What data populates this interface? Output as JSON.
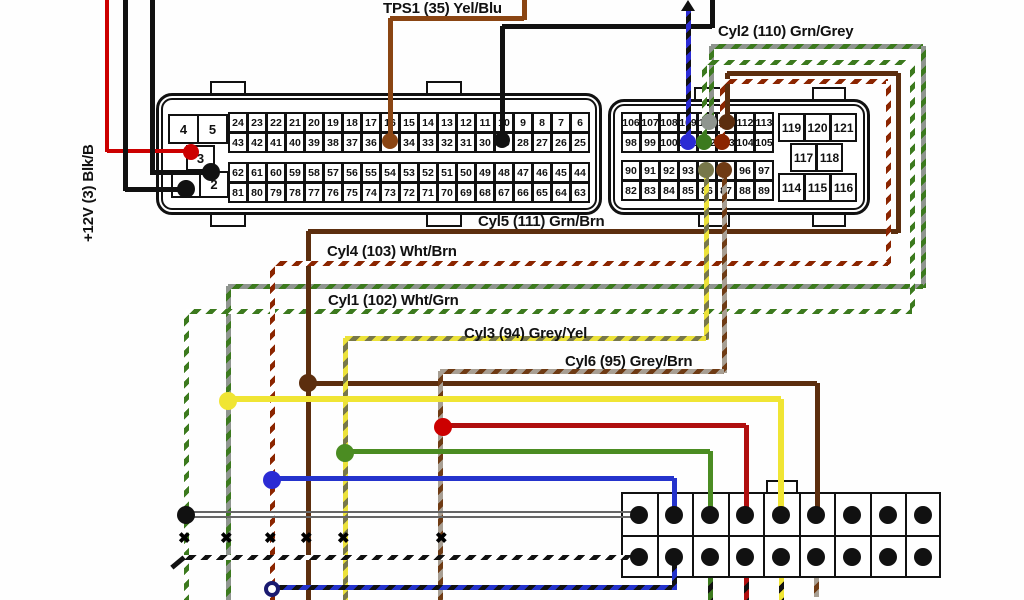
{
  "labels": {
    "plus12v": {
      "text": "+12V (3) Blk/B",
      "x": 80,
      "y": 242,
      "rotated": true
    },
    "tps1": {
      "text": "TPS1 (35) Yel/Blu",
      "x": 383,
      "y": 0
    },
    "cyl2": {
      "text": "Cyl2 (110) Grn/Grey",
      "x": 718,
      "y": 23
    },
    "cyl5": {
      "text": "Cyl5 (111) Grn/Brn",
      "x": 478,
      "y": 213
    },
    "cyl4": {
      "text": "Cyl4 (103) Wht/Brn",
      "x": 327,
      "y": 243
    },
    "cyl1": {
      "text": "Cyl1 (102) Wht/Grn",
      "x": 328,
      "y": 292
    },
    "cyl3": {
      "text": "Cyl3 (94) Grey/Yel",
      "x": 464,
      "y": 325
    },
    "cyl6": {
      "text": "Cyl6 (95) Grey/Brn",
      "x": 565,
      "y": 353
    }
  },
  "colors": {
    "black": "#111111",
    "red12v": "#cc0000",
    "tps_brown": "#8a4513",
    "cyl5_brown": "#5c2e0e",
    "cyl4_red": "#8b2500",
    "cyl1_green": "#3c7a1e",
    "cyl2_grey": "#8f958f",
    "cyl3_yellow": "#ece23a",
    "cyl3_dash": "#77774a",
    "cyl6_grey": "#a89f93",
    "cyl6_brown": "#6f3b14",
    "blue_wire": "#2b2bd4",
    "branch_yellow": "#f0e534",
    "branch_blue": "#2433cc",
    "branch_green": "#4b8c22",
    "branch_red": "#b00f0f",
    "pair_grey": "#666666",
    "white": "#ffffff"
  },
  "diagram": {
    "left_connector": {
      "name": "ecu-connector-left",
      "shell": {
        "x": 156,
        "y": 93,
        "w": 446,
        "h": 122
      },
      "tabs": [
        {
          "x": 210,
          "y": 81,
          "w": 36,
          "h": 14
        },
        {
          "x": 426,
          "y": 81,
          "w": 36,
          "h": 14
        },
        {
          "x": 210,
          "y": 213,
          "w": 36,
          "h": 14
        },
        {
          "x": 426,
          "y": 213,
          "w": 36,
          "h": 14
        }
      ],
      "small_pins": [
        {
          "label": "4",
          "x": 168,
          "y": 114,
          "w": 30,
          "h": 29
        },
        {
          "label": "5",
          "x": 197,
          "y": 114,
          "w": 30,
          "h": 29
        },
        {
          "label": "3",
          "x": 186,
          "y": 145,
          "w": 28,
          "h": 25
        },
        {
          "label": "1",
          "x": 171,
          "y": 171,
          "w": 29,
          "h": 26
        },
        {
          "label": "2",
          "x": 199,
          "y": 171,
          "w": 29,
          "h": 26
        }
      ],
      "blocks": [
        {
          "x": 228,
          "y": 112,
          "cw": 19,
          "ch": 20,
          "rows": [
            [
              24,
              23,
              22,
              21,
              20,
              19,
              18,
              17,
              16,
              15,
              14,
              13,
              12,
              11,
              10,
              9,
              8,
              7,
              6
            ],
            [
              43,
              42,
              41,
              40,
              39,
              38,
              37,
              36,
              35,
              34,
              33,
              32,
              31,
              30,
              29,
              28,
              27,
              26,
              25
            ]
          ]
        },
        {
          "x": 228,
          "y": 162,
          "cw": 19,
          "ch": 20,
          "rows": [
            [
              62,
              61,
              60,
              59,
              58,
              57,
              56,
              55,
              54,
              53,
              52,
              51,
              50,
              49,
              48,
              47,
              46,
              45,
              44
            ],
            [
              81,
              80,
              79,
              78,
              77,
              76,
              75,
              74,
              73,
              72,
              71,
              70,
              69,
              68,
              67,
              66,
              65,
              64,
              63
            ]
          ]
        }
      ]
    },
    "right_connector": {
      "name": "ecu-connector-right",
      "shell": {
        "x": 608,
        "y": 99,
        "w": 262,
        "h": 116
      },
      "tabs": [
        {
          "x": 694,
          "y": 87,
          "w": 36,
          "h": 14
        },
        {
          "x": 812,
          "y": 87,
          "w": 34,
          "h": 14
        },
        {
          "x": 698,
          "y": 213,
          "w": 32,
          "h": 14
        },
        {
          "x": 812,
          "y": 213,
          "w": 34,
          "h": 14
        }
      ],
      "blocks": [
        {
          "x": 621,
          "y": 112,
          "cw": 19,
          "ch": 20,
          "rows": [
            [
              106,
              107,
              108,
              109,
              110,
              111,
              112,
              113
            ],
            [
              98,
              99,
              100,
              101,
              102,
              103,
              104,
              105
            ]
          ]
        },
        {
          "x": 621,
          "y": 160,
          "cw": 19,
          "ch": 20,
          "rows": [
            [
              90,
              91,
              92,
              93,
              94,
              95,
              96,
              97
            ],
            [
              82,
              83,
              84,
              85,
              86,
              87,
              88,
              89
            ]
          ]
        }
      ],
      "side_cells": [
        {
          "label": "119",
          "x": 778,
          "y": 113,
          "w": 26,
          "h": 28
        },
        {
          "label": "120",
          "x": 804,
          "y": 113,
          "w": 26,
          "h": 28
        },
        {
          "label": "121",
          "x": 830,
          "y": 113,
          "w": 26,
          "h": 28
        },
        {
          "label": "117",
          "x": 790,
          "y": 143,
          "w": 26,
          "h": 28
        },
        {
          "label": "118",
          "x": 816,
          "y": 143,
          "w": 26,
          "h": 28
        },
        {
          "label": "114",
          "x": 778,
          "y": 173,
          "w": 26,
          "h": 28
        },
        {
          "label": "115",
          "x": 804,
          "y": 173,
          "w": 26,
          "h": 28
        },
        {
          "label": "116",
          "x": 830,
          "y": 173,
          "w": 26,
          "h": 28
        }
      ]
    },
    "bottom_connector": {
      "name": "coil-connector-strip",
      "x": 621,
      "y": 492,
      "w": 320,
      "h": 86,
      "cols": 9,
      "mid_y": 535,
      "tab": {
        "x": 766,
        "y": 480,
        "w": 32,
        "h": 14
      },
      "dot_cols": [
        639,
        674,
        710,
        745,
        781,
        816,
        852,
        888,
        923
      ],
      "dot_rows": [
        515,
        557
      ]
    },
    "wires": [
      {
        "name": "wire-12v",
        "w": 4,
        "base": "red12v",
        "segs": [
          [
            "v",
            107,
            0,
            152
          ],
          [
            "h",
            107,
            193,
            151
          ]
        ]
      },
      {
        "name": "wire-gnd-pin1",
        "w": 5,
        "base": "black",
        "segs": [
          [
            "v",
            125,
            0,
            191
          ],
          [
            "h",
            125,
            188,
            189
          ]
        ]
      },
      {
        "name": "wire-gnd-pin2",
        "w": 5,
        "base": "black",
        "segs": [
          [
            "v",
            152,
            0,
            175
          ],
          [
            "h",
            152,
            213,
            172
          ]
        ]
      },
      {
        "name": "wire-tps1",
        "w": 5,
        "base": "tps_brown",
        "segs": [
          [
            "v",
            524,
            0,
            20
          ],
          [
            "h",
            390,
            524,
            18
          ],
          [
            "v",
            390,
            18,
            144
          ]
        ]
      },
      {
        "name": "wire-black-pin29",
        "w": 5,
        "base": "black",
        "segs": [
          [
            "v",
            712,
            0,
            28
          ],
          [
            "h",
            502,
            712,
            26
          ],
          [
            "v",
            502,
            26,
            142
          ]
        ]
      },
      {
        "name": "wire-blue-pin101",
        "w": 5,
        "base": "blue_wire",
        "dash": "black",
        "segs": [
          [
            "v",
            688,
            9,
            144
          ]
        ]
      },
      {
        "name": "wire-cyl2",
        "w": 5,
        "base": "cyl2_grey",
        "dash": "cyl1_green",
        "segs": [
          [
            "v",
            711,
            46,
            122
          ],
          [
            "h",
            711,
            923,
            46
          ],
          [
            "v",
            923,
            46,
            288
          ],
          [
            "h",
            228,
            923,
            286
          ],
          [
            "v",
            228,
            286,
            600
          ]
        ]
      },
      {
        "name": "wire-cyl1",
        "w": 5,
        "base": "white",
        "dash": "cyl1_green",
        "segs": [
          [
            "v",
            704,
            62,
            142
          ],
          [
            "h",
            704,
            912,
            62
          ],
          [
            "v",
            912,
            62,
            313
          ],
          [
            "h",
            186,
            912,
            311
          ],
          [
            "v",
            186,
            311,
            600
          ]
        ]
      },
      {
        "name": "wire-cyl5",
        "w": 5,
        "base": "cyl5_brown",
        "segs": [
          [
            "v",
            727,
            73,
            122
          ],
          [
            "h",
            727,
            898,
            73
          ],
          [
            "v",
            898,
            73,
            233
          ],
          [
            "h",
            308,
            898,
            231
          ],
          [
            "v",
            308,
            231,
            600
          ],
          [
            "h",
            308,
            817,
            383
          ],
          [
            "v",
            817,
            383,
            517
          ]
        ]
      },
      {
        "name": "wire-cyl4",
        "w": 5,
        "base": "white",
        "dash": "cyl4_red",
        "segs": [
          [
            "v",
            722,
            81,
            142
          ],
          [
            "h",
            722,
            888,
            81
          ],
          [
            "v",
            888,
            81,
            265
          ],
          [
            "h",
            272,
            888,
            263
          ],
          [
            "v",
            272,
            263,
            600
          ]
        ]
      },
      {
        "name": "wire-cyl3",
        "w": 5,
        "base": "cyl3_yellow",
        "dash": "cyl3_dash",
        "segs": [
          [
            "v",
            706,
            172,
            340
          ],
          [
            "h",
            345,
            706,
            338
          ],
          [
            "v",
            345,
            338,
            600
          ]
        ]
      },
      {
        "name": "wire-cyl6",
        "w": 5,
        "base": "cyl6_grey",
        "dash": "cyl6_brown",
        "segs": [
          [
            "v",
            724,
            172,
            373
          ],
          [
            "h",
            440,
            724,
            371
          ],
          [
            "v",
            440,
            371,
            600
          ]
        ]
      },
      {
        "name": "branch-yellow-coil5",
        "w": 6,
        "base": "branch_yellow",
        "segs": [
          [
            "h",
            228,
            781,
            399
          ],
          [
            "v",
            781,
            399,
            517
          ]
        ]
      },
      {
        "name": "branch-red-coil4",
        "w": 5,
        "base": "branch_red",
        "segs": [
          [
            "h",
            443,
            746,
            425
          ],
          [
            "v",
            746,
            425,
            517
          ]
        ]
      },
      {
        "name": "branch-green-coil3",
        "w": 5,
        "base": "branch_green",
        "segs": [
          [
            "h",
            345,
            710,
            451
          ],
          [
            "v",
            710,
            451,
            517
          ]
        ]
      },
      {
        "name": "branch-blue-coil2",
        "w": 5,
        "base": "branch_blue",
        "segs": [
          [
            "h",
            272,
            674,
            478
          ],
          [
            "v",
            674,
            478,
            517
          ]
        ]
      },
      {
        "name": "pair-grey-coil1-a",
        "w": 2,
        "base": "pair_grey",
        "segs": [
          [
            "h",
            186,
            640,
            512
          ]
        ]
      },
      {
        "name": "pair-grey-coil1-b",
        "w": 2,
        "base": "pair_grey",
        "segs": [
          [
            "h",
            186,
            640,
            517
          ]
        ]
      },
      {
        "name": "dash-black-coil1",
        "w": 5,
        "base": "white",
        "dash": "black",
        "segs": [
          [
            "h",
            181,
            640,
            557
          ]
        ]
      },
      {
        "name": "dash-blueblack-coil2",
        "w": 5,
        "base": "branch_blue",
        "dash": "black",
        "segs": [
          [
            "h",
            272,
            674,
            587
          ],
          [
            "v",
            674,
            557,
            590
          ]
        ]
      },
      {
        "name": "stub-coil3",
        "w": 5,
        "base": "cyl1_green",
        "dash": "black",
        "segs": [
          [
            "v",
            710,
            578,
            600
          ]
        ]
      },
      {
        "name": "stub-coil4",
        "w": 5,
        "base": "branch_red",
        "dash": "black",
        "segs": [
          [
            "v",
            746,
            578,
            600
          ]
        ]
      },
      {
        "name": "stub-coil5",
        "w": 5,
        "base": "branch_yellow",
        "dash": "black",
        "segs": [
          [
            "v",
            781,
            578,
            600
          ]
        ]
      },
      {
        "name": "stub-coil6",
        "w": 5,
        "base": "cyl6_grey",
        "dash": "cyl6_brown",
        "segs": [
          [
            "v",
            816,
            578,
            597
          ]
        ]
      }
    ],
    "dots": [
      {
        "name": "pin3-dot",
        "x": 191,
        "y": 152,
        "r": 8,
        "fill": "red12v"
      },
      {
        "name": "pin1-dot",
        "x": 186,
        "y": 189,
        "r": 9,
        "fill": "black"
      },
      {
        "name": "pin2-dot",
        "x": 211,
        "y": 172,
        "r": 9,
        "fill": "black"
      },
      {
        "name": "pin35-dot",
        "x": 390,
        "y": 141,
        "r": 8,
        "fill": "tps_brown"
      },
      {
        "name": "pin29-dot",
        "x": 502,
        "y": 140,
        "r": 8,
        "fill": "black"
      },
      {
        "name": "pin101-dot",
        "x": 688,
        "y": 142,
        "r": 8,
        "fill": "blue_wire"
      },
      {
        "name": "pin110-dot",
        "x": 709,
        "y": 122,
        "r": 8,
        "fill": "cyl2_grey"
      },
      {
        "name": "pin102-dot",
        "x": 704,
        "y": 142,
        "r": 8,
        "fill": "cyl1_green"
      },
      {
        "name": "pin111-dot",
        "x": 727,
        "y": 122,
        "r": 8,
        "fill": "cyl5_brown"
      },
      {
        "name": "pin103-dot",
        "x": 722,
        "y": 142,
        "r": 8,
        "fill": "cyl4_red"
      },
      {
        "name": "pin94-dot",
        "x": 706,
        "y": 170,
        "r": 8,
        "fill": "cyl3_dash"
      },
      {
        "name": "pin95-dot",
        "x": 724,
        "y": 170,
        "r": 8,
        "fill": "cyl6_brown"
      },
      {
        "name": "junction-cyl5-brown",
        "x": 308,
        "y": 383,
        "r": 9,
        "fill": "cyl5_brown"
      },
      {
        "name": "junction-cyl2-yellow",
        "x": 228,
        "y": 401,
        "r": 9,
        "fill": "branch_yellow"
      },
      {
        "name": "junction-cyl6-red",
        "x": 443,
        "y": 427,
        "r": 9,
        "fill": "red12v"
      },
      {
        "name": "junction-cyl3-green",
        "x": 345,
        "y": 453,
        "r": 9,
        "fill": "branch_green"
      },
      {
        "name": "junction-cyl4-blue",
        "x": 272,
        "y": 480,
        "r": 9,
        "fill": "blue_wire"
      },
      {
        "name": "junction-cyl1-black",
        "x": 186,
        "y": 515,
        "r": 9,
        "fill": "black"
      }
    ],
    "xmarks": {
      "y": 539,
      "xs": [
        186,
        228,
        272,
        308,
        345,
        443
      ],
      "glyph": "✖"
    },
    "arrow_up": {
      "x": 688,
      "y": 0
    },
    "open_circle": {
      "x": 272,
      "y": 589,
      "r": 8
    },
    "hook": {
      "x": 170,
      "y": 560
    }
  }
}
